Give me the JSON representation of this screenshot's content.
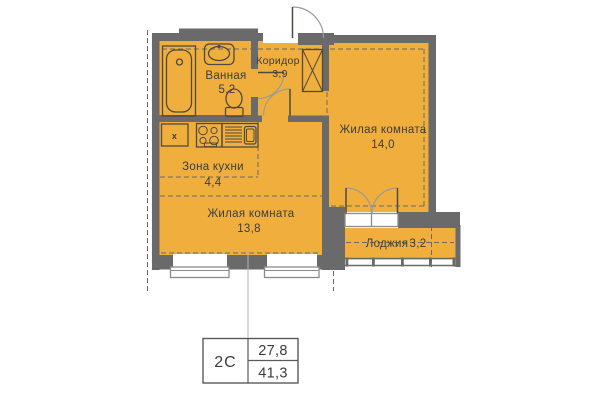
{
  "plan": {
    "rooms": {
      "bathroom": {
        "name": "Ванная",
        "area": "5,2"
      },
      "corridor": {
        "name": "Коридор",
        "area": "3,9"
      },
      "living_room_right": {
        "name": "Жилая комната",
        "area": "14,0"
      },
      "kitchen_zone": {
        "name": "Зона кухни",
        "area": "4,4"
      },
      "living_room_left": {
        "name": "Жилая комната",
        "area": "13,8"
      },
      "loggia": {
        "name": "Лоджия",
        "area": "3,2"
      }
    },
    "fixtures": {
      "washer_mark": "x"
    },
    "summary": {
      "layout_code": "2С",
      "living_area": "27,8",
      "total_area": "41,3"
    }
  },
  "colors": {
    "bg": "#ffffff",
    "room-fill": "#f0af3d",
    "wall": "#6a6a6a",
    "outline": "#4e4a40",
    "text": "#3d3d3b",
    "arc": "#9a9a9a",
    "leader": "#b5b5b5",
    "sill-stroke": "#8c8c8c"
  }
}
